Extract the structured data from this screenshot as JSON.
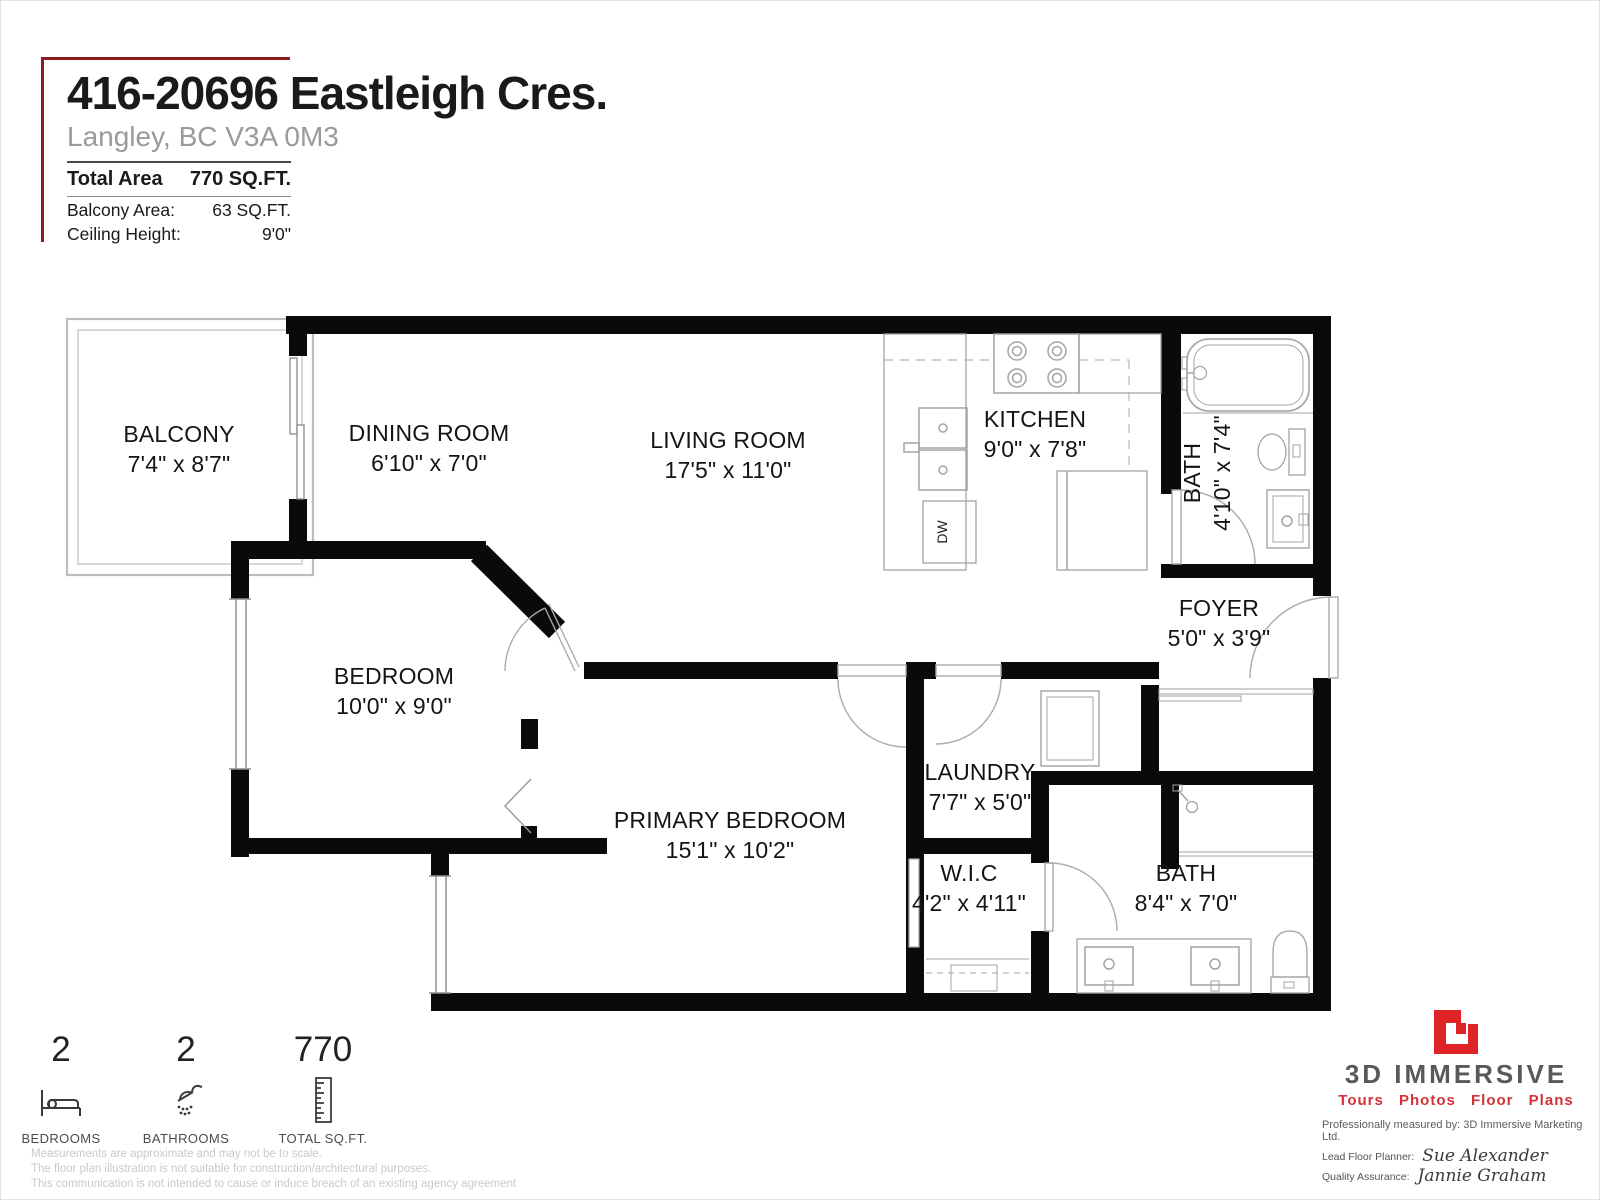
{
  "header": {
    "address": "416-20696 Eastleigh Cres.",
    "city": "Langley, BC V3A 0M3",
    "total_area_label": "Total Area",
    "total_area_value": "770 SQ.FT.",
    "balcony_label": "Balcony Area:",
    "balcony_value": "63 SQ.FT.",
    "ceiling_label": "Ceiling Height:",
    "ceiling_value": "9'0\""
  },
  "rooms": [
    {
      "name": "BALCONY",
      "dims": "7'4\" x 8'7\""
    },
    {
      "name": "DINING ROOM",
      "dims": "6'10\" x 7'0\""
    },
    {
      "name": "LIVING ROOM",
      "dims": "17'5\" x 11'0\""
    },
    {
      "name": "KITCHEN",
      "dims": "9'0\" x 7'8\""
    },
    {
      "name": "BATH",
      "dims": "4'10\" x 7'4\""
    },
    {
      "name": "FOYER",
      "dims": "5'0\" x 3'9\""
    },
    {
      "name": "BEDROOM",
      "dims": "10'0\" x 9'0\""
    },
    {
      "name": "PRIMARY BEDROOM",
      "dims": "15'1\" x 10'2\""
    },
    {
      "name": "LAUNDRY",
      "dims": "7'7\" x 5'0\""
    },
    {
      "name": "W.I.C",
      "dims": "4'2\" x 4'11\""
    },
    {
      "name": "BATH",
      "dims": "8'4\" x 7'0\""
    }
  ],
  "fixtures": {
    "dishwasher_label": "DW"
  },
  "stats": [
    {
      "value": "2",
      "label": "BEDROOMS"
    },
    {
      "value": "2",
      "label": "BATHROOMS"
    },
    {
      "value": "770",
      "label": "TOTAL SQ.FT."
    }
  ],
  "branding": {
    "company": "3D IMMERSIVE",
    "tagline": "Tours  Photos  Floor Plans",
    "measured_by": "Professionally measured by: 3D Immersive Marketing Ltd.",
    "planner_label": "Lead Floor Planner:",
    "planner_name": "Sue Alexander",
    "qa_label": "Quality Assurance:",
    "qa_name": "Jannie Graham"
  },
  "disclaimer": [
    "Measurements are approximate and may not be to scale.",
    "The floor plan illustration is not suitable for construction/architectural purposes.",
    "This communication is not intended to cause or induce breach of an existing agency agreement"
  ],
  "colors": {
    "wall_black": "#0a0a0a",
    "bracket_red": "#8e1c1c",
    "logo_red": "#e02327",
    "tagline_red": "#d23237",
    "brand_gray": "#58595b"
  }
}
